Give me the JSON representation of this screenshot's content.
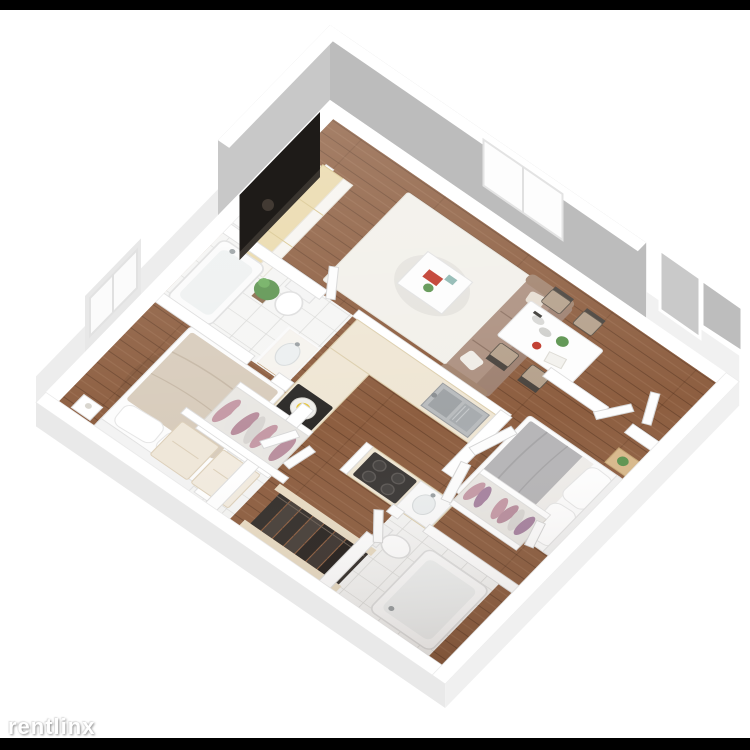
{
  "watermark": {
    "text": "rentlinx"
  },
  "scene": {
    "title": "3D isometric apartment floor plan",
    "style": "dollhouse cutaway render on white background",
    "rooms": [
      {
        "name": "living-room",
        "floor": "hardwood",
        "contents": [
          "flat-screen tv",
          "media console",
          "staircase-up",
          "potted plant",
          "area rug",
          "coffee table",
          "sofa"
        ]
      },
      {
        "name": "dining-area",
        "floor": "hardwood",
        "contents": [
          "dining table",
          "four chairs",
          "window"
        ]
      },
      {
        "name": "kitchen",
        "floor": "hardwood",
        "contents": [
          "l-shaped counter",
          "double stainless sink",
          "cooktop with pot"
        ]
      },
      {
        "name": "bedroom-1",
        "floor": "hardwood",
        "contents": [
          "double bed",
          "nightstands",
          "window",
          "closet with hanging clothes"
        ]
      },
      {
        "name": "bathroom-1",
        "floor": "tile",
        "contents": [
          "bathtub",
          "toilet",
          "wood vanity sink"
        ]
      },
      {
        "name": "bedroom-2",
        "floor": "hardwood",
        "contents": [
          "double bed",
          "nightstand",
          "plant",
          "wardrobe doors",
          "closet with hanging clothes"
        ]
      },
      {
        "name": "bathroom-2",
        "floor": "tile",
        "contents": [
          "bathtub",
          "toilet",
          "vanity sink",
          "gas cooktop counter"
        ]
      },
      {
        "name": "utility-room",
        "floor": "tile",
        "contents": [
          "washer",
          "dryer"
        ]
      },
      {
        "name": "stairwell",
        "floor": "hardwood",
        "contents": [
          "staircase-down"
        ]
      }
    ],
    "colors": {
      "background": "#ffffff",
      "frame_bar": "#000000",
      "wood_floor": "#8d5e40",
      "tile_floor": "#f5f5f4",
      "wall_white": "#ffffff",
      "wall_interior_gray": "#bcbcbc",
      "wall_interior_gray2": "#c8c8c8",
      "sofa_tan": "#ad9181",
      "bed1_blanket": "#d8ccbc",
      "bed2_blanket": "#b6b5b7",
      "counter_cream": "#efe6d4",
      "cooktop_black": "#2d2b29",
      "tv_black": "#1e1b18",
      "clothes_pink": "#c59aa6",
      "plant_green": "#5d9450",
      "stair_dark": "#332e2a",
      "rug": "#f2f0ea",
      "accent_red": "#c0392b"
    }
  }
}
